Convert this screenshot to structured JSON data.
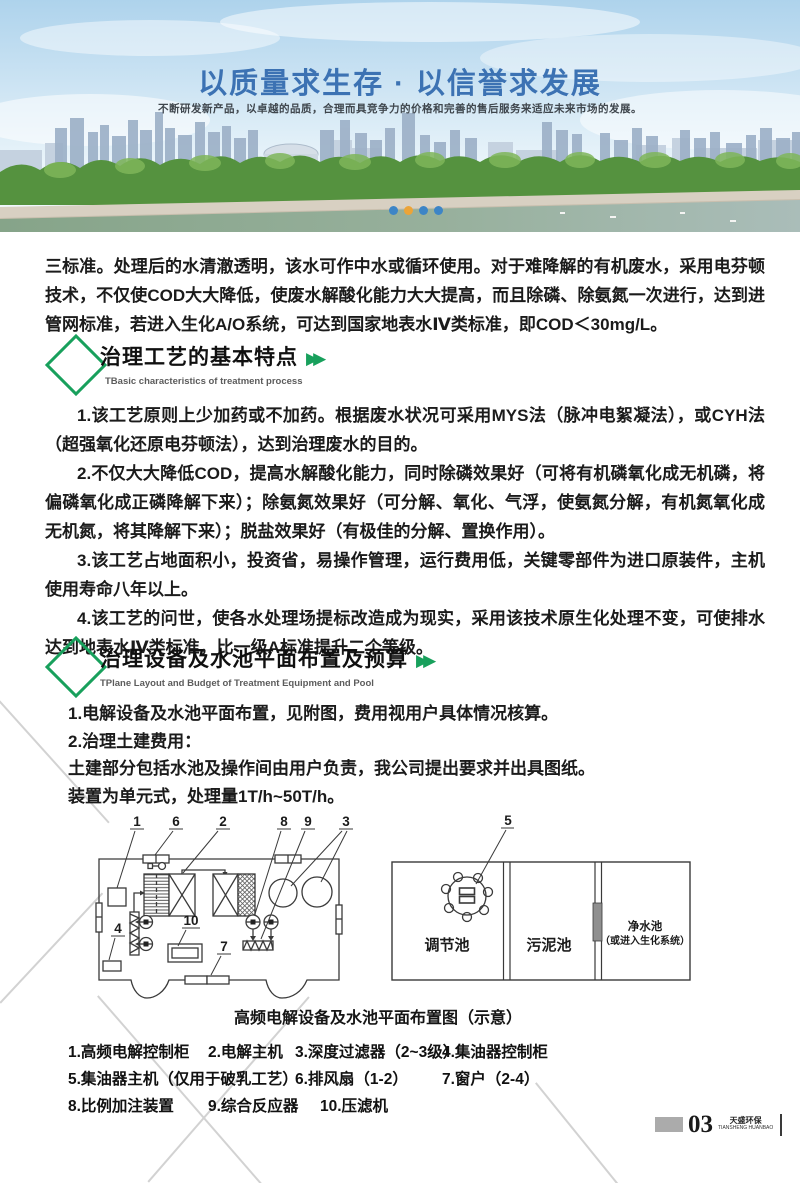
{
  "hero": {
    "title": "以质量求生存 · 以信誉求发展",
    "subtitle": "不断研发新产品，以卓越的品质，合理而具竞争力的价格和完善的售后服务来适应未来市场的发展。",
    "dot_colors": [
      "#3d85c6",
      "#eca438",
      "#3d85c6",
      "#3d85c6"
    ]
  },
  "colors": {
    "accent_green": "#18a05c",
    "title_blue": "#3c72b3"
  },
  "intro_paragraph": "三标准。处理后的水清澈透明，该水可作中水或循环使用。对于难降解的有机废水，采用电芬顿技术，不仅使COD大大降低，使废水解酸化能力大大提高，而且除磷、除氨氮一次进行，达到进管网标准，若进入生化A/O系统，可达到国家地表水Ⅳ类标准，即COD＜30mg/L。",
  "section1": {
    "title": "治理工艺的基本特点",
    "arrows": "▶▶",
    "subtitle_en": "TBasic characteristics of treatment process",
    "paragraphs": [
      "1.该工艺原则上少加药或不加药。根据废水状况可采用MYS法（脉冲电絮凝法），或CYH法（超强氧化还原电芬顿法），达到治理废水的目的。",
      "2.不仅大大降低COD，提高水解酸化能力，同时除磷效果好（可将有机磷氧化成无机磷，将偏磷氧化成正磷降解下来）；除氨氮效果好（可分解、氧化、气浮，使氨氮分解，有机氮氧化成无机氮，将其降解下来）；脱盐效果好（有极佳的分解、置换作用）。",
      "3.该工艺占地面积小，投资省，易操作管理，运行费用低，关键零部件为进口原装件，主机使用寿命八年以上。",
      "4.该工艺的问世，使各水处理场提标改造成为现实，采用该技术原生化处理不变，可使排水达到地表水Ⅳ类标准，比一级A标准提升二个等级。"
    ]
  },
  "section2": {
    "title": "治理设备及水池平面布置及预算",
    "arrows": "▶▶",
    "subtitle_en": "TPlane Layout and Budget of Treatment Equipment and Pool",
    "lines": [
      "1.电解设备及水池平面布置，见附图，费用视用户具体情况核算。",
      "2.治理土建费用：",
      "土建部分包括水池及操作间由用户负责，我公司提出要求并出具图纸。",
      "装置为单元式，处理量1T/h~50T/h。"
    ]
  },
  "diagram": {
    "caption": "高频电解设备及水池平面布置图（示意）",
    "left_callouts": {
      "c1": "1",
      "c2": "2",
      "c3": "3",
      "c4": "4",
      "c6": "6",
      "c7": "7",
      "c8": "8",
      "c9": "9",
      "c10": "10"
    },
    "right_callout": "5",
    "pools": {
      "p1": "调节池",
      "p2": "污泥池",
      "p3a": "净水池",
      "p3b": "（或进入生化系统）"
    }
  },
  "legend": {
    "items": [
      "1.高频电解控制柜",
      "2.电解主机",
      "3.深度过滤器（2~3级）",
      "4.集油器控制柜",
      "5.集油器主机（仅用于破乳工艺）",
      "6.排风扇（1-2）",
      "7.窗户（2-4）",
      "8.比例加注装置",
      "9.综合反应器",
      "10.压滤机"
    ]
  },
  "footer": {
    "page_number": "03",
    "brand": "天盛环保",
    "brand_en": "TIANSHENG HUANBAO"
  }
}
